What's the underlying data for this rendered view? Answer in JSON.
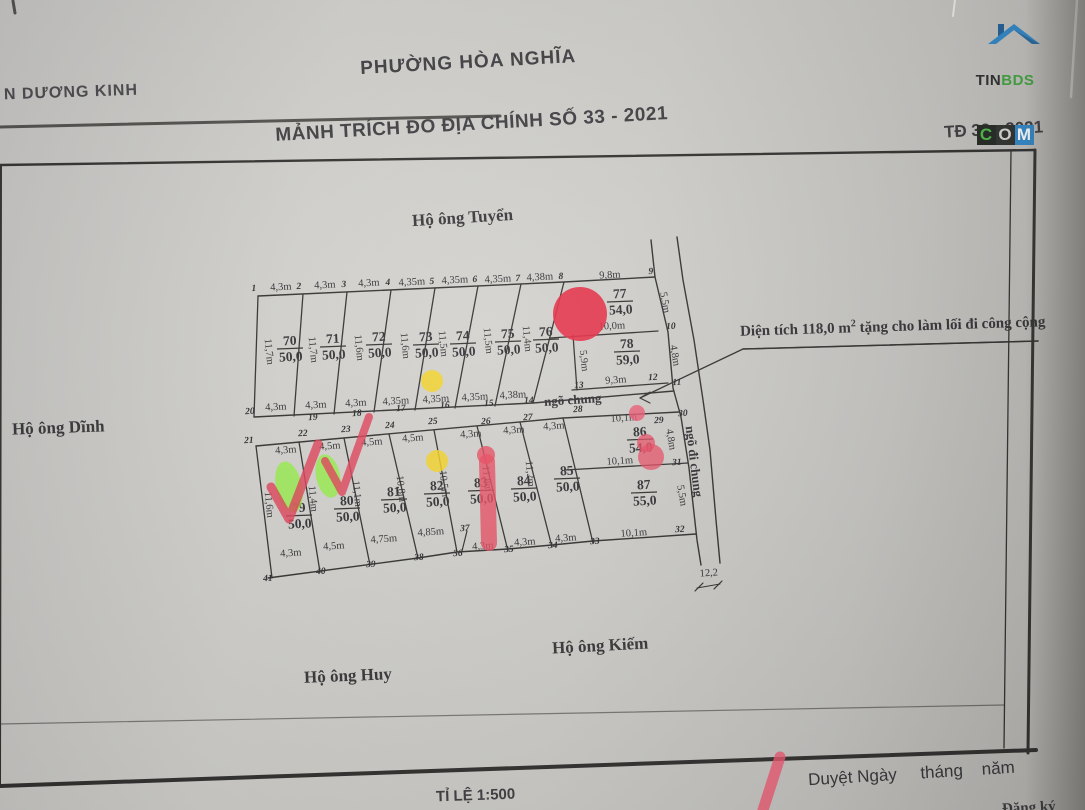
{
  "header": {
    "line1": "PHƯỜNG HÒA NGHĨA",
    "line2": "MẢNH TRÍCH ĐO ĐỊA CHÍNH SỐ 33 - 2021",
    "district": "N DƯƠNG KINH",
    "sheet": "TĐ 33 - 2021"
  },
  "logo": {
    "tin": "TIN",
    "bds": "BDS",
    "c": "C",
    "o": "O",
    "m": "M"
  },
  "neighbors": {
    "top": "Hộ ông Tuyển",
    "left": "Hộ ông Dĩnh",
    "bottom_right": "Hộ ông Kiếm",
    "bottom_left": "Hộ ông Huy"
  },
  "annotation": {
    "before_sup": "Diện tích 118,0 m",
    "sup": "2",
    "after_sup": " tặng cho làm lối đi công cộng"
  },
  "footer": {
    "scale": "TỈ LỆ 1:500",
    "approval": "Duyệt Ngày     tháng    năm",
    "partial": "Đăng ký"
  },
  "colors": {
    "ink": "#2e2d2b",
    "red": "#e52840",
    "yellow": "#f4d321",
    "green": "#8ef237"
  },
  "map": {
    "plots": [
      {
        "no": "70",
        "area": "50,0",
        "x": 290,
        "y": 345
      },
      {
        "no": "71",
        "area": "50,0",
        "x": 333,
        "y": 343
      },
      {
        "no": "72",
        "area": "50,0",
        "x": 379,
        "y": 341
      },
      {
        "no": "73",
        "area": "50,0",
        "x": 426,
        "y": 341
      },
      {
        "no": "74",
        "area": "50,0",
        "x": 463,
        "y": 340
      },
      {
        "no": "75",
        "area": "50,0",
        "x": 508,
        "y": 338
      },
      {
        "no": "76",
        "area": "50,0",
        "x": 546,
        "y": 336
      },
      {
        "no": "77",
        "area": "54,0",
        "x": 620,
        "y": 298
      },
      {
        "no": "78",
        "area": "59,0",
        "x": 627,
        "y": 348
      },
      {
        "no": "79",
        "area": "50,0",
        "x": 299,
        "y": 512
      },
      {
        "no": "80",
        "area": "50,0",
        "x": 347,
        "y": 505
      },
      {
        "no": "81",
        "area": "50,0",
        "x": 394,
        "y": 496
      },
      {
        "no": "82",
        "area": "50,0",
        "x": 437,
        "y": 490
      },
      {
        "no": "83",
        "area": "50,0",
        "x": 481,
        "y": 487
      },
      {
        "no": "84",
        "area": "50,0",
        "x": 524,
        "y": 485
      },
      {
        "no": "85",
        "area": "50,0",
        "x": 567,
        "y": 475
      },
      {
        "no": "86",
        "area": "54,0",
        "x": 640,
        "y": 436
      },
      {
        "no": "87",
        "area": "55,0",
        "x": 644,
        "y": 489
      }
    ],
    "dims": [
      {
        "t": "4,3m",
        "x": 281,
        "y": 290,
        "r": -3
      },
      {
        "t": "4,3m",
        "x": 325,
        "y": 288,
        "r": -3
      },
      {
        "t": "4,3m",
        "x": 369,
        "y": 286,
        "r": -3
      },
      {
        "t": "4,35m",
        "x": 412,
        "y": 285,
        "r": -3
      },
      {
        "t": "4,35m",
        "x": 455,
        "y": 283,
        "r": -3
      },
      {
        "t": "4,35m",
        "x": 498,
        "y": 282,
        "r": -3
      },
      {
        "t": "4,38m",
        "x": 540,
        "y": 280,
        "r": -3
      },
      {
        "t": "9,8m",
        "x": 610,
        "y": 278,
        "r": -3
      },
      {
        "t": "11,7m",
        "x": 266,
        "y": 352,
        "r": 84
      },
      {
        "t": "11,7m",
        "x": 310,
        "y": 350,
        "r": 84
      },
      {
        "t": "11,6m",
        "x": 356,
        "y": 348,
        "r": 84
      },
      {
        "t": "11,6m",
        "x": 402,
        "y": 346,
        "r": 84
      },
      {
        "t": "11,5m",
        "x": 440,
        "y": 344,
        "r": 84
      },
      {
        "t": "11,5m",
        "x": 485,
        "y": 341,
        "r": 84
      },
      {
        "t": "11,4m",
        "x": 524,
        "y": 339,
        "r": 84
      },
      {
        "t": "5,5m",
        "x": 662,
        "y": 303,
        "r": 80
      },
      {
        "t": "10,0m",
        "x": 612,
        "y": 329,
        "r": -3
      },
      {
        "t": "4,8m",
        "x": 672,
        "y": 356,
        "r": 80
      },
      {
        "t": "9,3m",
        "x": 616,
        "y": 383,
        "r": -4
      },
      {
        "t": "5,9m",
        "x": 581,
        "y": 361,
        "r": 84
      },
      {
        "t": "4,3m",
        "x": 276,
        "y": 410,
        "r": -3
      },
      {
        "t": "4,3m",
        "x": 316,
        "y": 408,
        "r": -3
      },
      {
        "t": "4,3m",
        "x": 356,
        "y": 406,
        "r": -3
      },
      {
        "t": "4,35m",
        "x": 396,
        "y": 404,
        "r": -3
      },
      {
        "t": "4,35m",
        "x": 436,
        "y": 402,
        "r": -3
      },
      {
        "t": "4,35m",
        "x": 475,
        "y": 400,
        "r": -3
      },
      {
        "t": "4,38m",
        "x": 513,
        "y": 398,
        "r": -3
      },
      {
        "t": "4,3m",
        "x": 286,
        "y": 453,
        "r": -4
      },
      {
        "t": "4,5m",
        "x": 330,
        "y": 449,
        "r": -4
      },
      {
        "t": "4,5m",
        "x": 372,
        "y": 445,
        "r": -4
      },
      {
        "t": "4,5m",
        "x": 413,
        "y": 441,
        "r": -4
      },
      {
        "t": "4,3m",
        "x": 471,
        "y": 437,
        "r": -4
      },
      {
        "t": "4,3m",
        "x": 514,
        "y": 433,
        "r": -4
      },
      {
        "t": "4,3m",
        "x": 554,
        "y": 429,
        "r": -4
      },
      {
        "t": "10,1m",
        "x": 624,
        "y": 421,
        "r": -4
      },
      {
        "t": "11,6m",
        "x": 266,
        "y": 505,
        "r": 84
      },
      {
        "t": "11,4m",
        "x": 310,
        "y": 499,
        "r": 84
      },
      {
        "t": "11,1m",
        "x": 354,
        "y": 494,
        "r": 84
      },
      {
        "t": "10,8m",
        "x": 398,
        "y": 489,
        "r": 84
      },
      {
        "t": "10,5m",
        "x": 441,
        "y": 484,
        "r": 84
      },
      {
        "t": "11,8m",
        "x": 484,
        "y": 479,
        "r": 84
      },
      {
        "t": "11,2m",
        "x": 527,
        "y": 474,
        "r": 84
      },
      {
        "t": "10,1m",
        "x": 620,
        "y": 464,
        "r": -4
      },
      {
        "t": "4,8m",
        "x": 668,
        "y": 440,
        "r": 80
      },
      {
        "t": "5,5m",
        "x": 679,
        "y": 496,
        "r": 80
      },
      {
        "t": "4,3m",
        "x": 291,
        "y": 556,
        "r": -4
      },
      {
        "t": "4,5m",
        "x": 334,
        "y": 549,
        "r": -4
      },
      {
        "t": "4,75m",
        "x": 384,
        "y": 542,
        "r": -4
      },
      {
        "t": "4,85m",
        "x": 431,
        "y": 535,
        "r": -4
      },
      {
        "t": "4,3m",
        "x": 483,
        "y": 549,
        "r": -4
      },
      {
        "t": "4,3m",
        "x": 525,
        "y": 545,
        "r": -4
      },
      {
        "t": "4,3m",
        "x": 566,
        "y": 541,
        "r": -4
      },
      {
        "t": "10,1m",
        "x": 634,
        "y": 536,
        "r": -4
      },
      {
        "t": "12,2",
        "x": 709,
        "y": 576,
        "r": -4
      }
    ],
    "points": [
      {
        "n": "1",
        "x": 254,
        "y": 291
      },
      {
        "n": "2",
        "x": 299,
        "y": 289
      },
      {
        "n": "3",
        "x": 344,
        "y": 287
      },
      {
        "n": "4",
        "x": 388,
        "y": 285
      },
      {
        "n": "5",
        "x": 432,
        "y": 284
      },
      {
        "n": "6",
        "x": 475,
        "y": 282
      },
      {
        "n": "7",
        "x": 518,
        "y": 281
      },
      {
        "n": "8",
        "x": 561,
        "y": 279
      },
      {
        "n": "9",
        "x": 651,
        "y": 274
      },
      {
        "n": "10",
        "x": 671,
        "y": 329
      },
      {
        "n": "11",
        "x": 677,
        "y": 385
      },
      {
        "n": "12",
        "x": 653,
        "y": 380
      },
      {
        "n": "13",
        "x": 579,
        "y": 388
      },
      {
        "n": "14",
        "x": 529,
        "y": 403
      },
      {
        "n": "15",
        "x": 489,
        "y": 406
      },
      {
        "n": "16",
        "x": 445,
        "y": 408
      },
      {
        "n": "17",
        "x": 401,
        "y": 411
      },
      {
        "n": "18",
        "x": 357,
        "y": 416
      },
      {
        "n": "19",
        "x": 313,
        "y": 420
      },
      {
        "n": "20",
        "x": 250,
        "y": 414
      },
      {
        "n": "21",
        "x": 249,
        "y": 443
      },
      {
        "n": "22",
        "x": 303,
        "y": 436
      },
      {
        "n": "23",
        "x": 346,
        "y": 432
      },
      {
        "n": "24",
        "x": 390,
        "y": 428
      },
      {
        "n": "25",
        "x": 433,
        "y": 424
      },
      {
        "n": "26",
        "x": 486,
        "y": 424
      },
      {
        "n": "27",
        "x": 528,
        "y": 420
      },
      {
        "n": "28",
        "x": 578,
        "y": 412
      },
      {
        "n": "29",
        "x": 659,
        "y": 423
      },
      {
        "n": "30",
        "x": 683,
        "y": 416
      },
      {
        "n": "31",
        "x": 677,
        "y": 465
      },
      {
        "n": "32",
        "x": 680,
        "y": 532
      },
      {
        "n": "33",
        "x": 595,
        "y": 544
      },
      {
        "n": "34",
        "x": 553,
        "y": 548
      },
      {
        "n": "35",
        "x": 509,
        "y": 552
      },
      {
        "n": "36",
        "x": 458,
        "y": 556
      },
      {
        "n": "37",
        "x": 465,
        "y": 531
      },
      {
        "n": "38",
        "x": 419,
        "y": 560
      },
      {
        "n": "39",
        "x": 371,
        "y": 567
      },
      {
        "n": "40",
        "x": 321,
        "y": 574
      },
      {
        "n": "41",
        "x": 268,
        "y": 581
      }
    ],
    "alleys": [
      {
        "t": "ngõ chung",
        "x": 573,
        "y": 404,
        "r": -4
      },
      {
        "t": "ngõ đi chung",
        "x": 690,
        "y": 462,
        "r": 83
      }
    ],
    "lines": [
      {
        "n": "map-border-top-outer",
        "p": "0,127 360,119 500,116",
        "w": 3,
        "o": 0.8
      },
      {
        "n": "map-border-top",
        "p": "0,165 1035,150",
        "w": 2.4
      },
      {
        "n": "map-border-right-outer",
        "p": "1035,150 1028,753",
        "w": 3
      },
      {
        "n": "map-border-right-inner",
        "p": "1011,151 1004,748",
        "w": 1.3
      },
      {
        "n": "map-border-bottom-outer",
        "p": "0,786 1036,750",
        "w": 4
      },
      {
        "n": "map-border-bottom-inner",
        "p": "0,724 1004,705",
        "w": 1.2,
        "o": 0.55
      },
      {
        "n": "map-border-left",
        "p": "1,166 0,786",
        "w": 2
      },
      {
        "n": "corner-tick",
        "p": "13,1 15,13",
        "w": 3,
        "o": 0.8
      },
      {
        "n": "paper-edge",
        "p": "955,0 953,16",
        "w": 2,
        "s": "#ecebe7"
      },
      {
        "n": "paper-edge",
        "p": "1077,0 1071,97",
        "w": 2.5,
        "s": "#ecebe7"
      },
      {
        "n": "parcel-row1-top",
        "p": "258,296 564,282 655,277",
        "w": 1.4
      },
      {
        "n": "parcel-row1-bottom",
        "p": "254,417 533,403 674,391",
        "w": 1.4
      },
      {
        "n": "parcel-boundary",
        "p": "258,296 254,417",
        "w": 1.3
      },
      {
        "n": "parcel-boundary",
        "p": "303,294 294,416",
        "w": 1.3
      },
      {
        "n": "parcel-boundary",
        "p": "347,292 334,414",
        "w": 1.3
      },
      {
        "n": "parcel-boundary",
        "p": "391,290 374,412",
        "w": 1.3
      },
      {
        "n": "parcel-boundary",
        "p": "435,288 415,410",
        "w": 1.3
      },
      {
        "n": "parcel-boundary",
        "p": "478,286 455,408",
        "w": 1.3
      },
      {
        "n": "parcel-boundary",
        "p": "521,284 495,406",
        "w": 1.3
      },
      {
        "n": "parcel-boundary",
        "p": "564,282 533,403",
        "w": 1.3
      },
      {
        "n": "parcel-77-bottom",
        "p": "550,338 658,331",
        "w": 1.3
      },
      {
        "n": "parcel-78-left",
        "p": "573,335 577,390",
        "w": 1.3
      },
      {
        "n": "parcel-78-bottom",
        "p": "572,390 668,383",
        "w": 1.3
      },
      {
        "n": "road-left-line",
        "p": "651,240 655,277 668,332 673,388 681,417 689,468 697,540 701,565",
        "w": 1.4
      },
      {
        "n": "road-right-line",
        "p": "677,237 683,280 694,340 703,400 710,450 716,520 720,563",
        "w": 1.4
      },
      {
        "n": "parcel-row2-top",
        "p": "256,446 563,418 679,412",
        "w": 1.4
      },
      {
        "n": "parcel-boundary",
        "p": "256,446 272,578",
        "w": 1.3
      },
      {
        "n": "parcel-boundary",
        "p": "299,442 320,572",
        "w": 1.3
      },
      {
        "n": "parcel-boundary",
        "p": "344,438 370,565",
        "w": 1.3
      },
      {
        "n": "parcel-boundary",
        "p": "389,434 418,558",
        "w": 1.3
      },
      {
        "n": "parcel-boundary",
        "p": "434,430 457,552",
        "w": 1.3
      },
      {
        "n": "parcel-boundary",
        "p": "477,426 508,551",
        "w": 1.3
      },
      {
        "n": "parcel-boundary",
        "p": "520,422 552,547",
        "w": 1.3
      },
      {
        "n": "parcel-boundary",
        "p": "563,418 593,543",
        "w": 1.3
      },
      {
        "n": "parcel-row2-bottom",
        "p": "268,578 418,558 457,552 508,549 552,545 593,541 696,534",
        "w": 1.4
      },
      {
        "n": "parcel-86-87-divider",
        "p": "565,470 688,463",
        "w": 1.3
      },
      {
        "n": "parcel-notch",
        "p": "462,551 467,531",
        "w": 1.2
      },
      {
        "n": "annotation-underline",
        "p": "743,349 1038,341",
        "w": 1.5
      },
      {
        "n": "leader-line",
        "p": "1038,341 743,349 640,398",
        "w": 1.3
      },
      {
        "n": "leader-arrowhead",
        "p": "650,392 640,398 650,403",
        "w": 1.2
      },
      {
        "n": "road-dim-tick",
        "p": "695,591 703,583",
        "w": 1.2
      },
      {
        "n": "road-dim-tick",
        "p": "714,589 722,581",
        "w": 1.2
      },
      {
        "n": "road-dim-line",
        "p": "697,588 720,584",
        "w": 1
      }
    ],
    "markers": [
      {
        "type": "circle",
        "name": "red-circle-marker",
        "x": 580,
        "y": 314,
        "r": 27,
        "f": "#e52840",
        "o": 0.9
      },
      {
        "type": "circle",
        "name": "yellow-dot-marker",
        "x": 432,
        "y": 381,
        "r": 11,
        "f": "#f4d321",
        "o": 0.85
      },
      {
        "type": "circle",
        "name": "yellow-dot-marker",
        "x": 437,
        "y": 461,
        "r": 11,
        "f": "#f4d321",
        "o": 0.85
      },
      {
        "type": "ellipse",
        "name": "green-highlight-marker",
        "x": 289,
        "y": 487,
        "rx": 13,
        "ry": 26,
        "rot": -12,
        "f": "#8ef237",
        "o": 0.75
      },
      {
        "type": "ellipse",
        "name": "green-highlight-marker",
        "x": 328,
        "y": 476,
        "rx": 12,
        "ry": 22,
        "rot": -12,
        "f": "#8ef237",
        "o": 0.75
      },
      {
        "type": "stroke",
        "name": "red-check-marker",
        "p": "271,487 289,519 318,444",
        "w": 9,
        "s": "#e23d55",
        "o": 0.82
      },
      {
        "type": "stroke",
        "name": "red-check-marker",
        "p": "325,461 342,492 369,417",
        "w": 8,
        "s": "#e23d55",
        "o": 0.82
      },
      {
        "type": "stroke",
        "name": "red-bar-marker",
        "p": "487,462 489,543",
        "w": 16,
        "s": "#e8495e",
        "o": 0.8
      },
      {
        "type": "circle",
        "name": "red-bar-cap-marker",
        "x": 486,
        "y": 455,
        "r": 9,
        "f": "#e8495e",
        "o": 0.8
      },
      {
        "type": "circle",
        "name": "red-blob-marker",
        "x": 646,
        "y": 443,
        "r": 9,
        "f": "#ea4a62",
        "o": 0.75
      },
      {
        "type": "circle",
        "name": "red-blob-marker",
        "x": 651,
        "y": 457,
        "r": 13,
        "f": "#ea4a62",
        "o": 0.75
      },
      {
        "type": "circle",
        "name": "red-dot-marker",
        "x": 637,
        "y": 413,
        "r": 8,
        "f": "#ee5570",
        "o": 0.8
      },
      {
        "type": "stroke",
        "name": "red-pen-stroke",
        "p": "780,757 763,810",
        "w": 11,
        "s": "#f25670",
        "o": 0.8
      }
    ]
  }
}
